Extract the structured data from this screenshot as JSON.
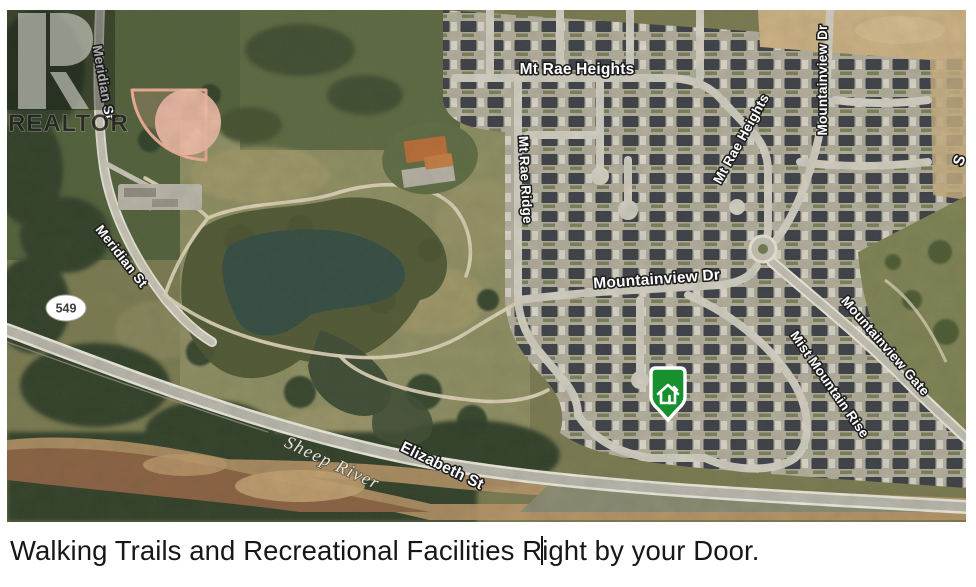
{
  "caption": {
    "before_cursor": "Walking Trails and Recreational Facilities R",
    "after_cursor": "ight by your Door."
  },
  "watermark": {
    "brand": "REALTOR",
    "registered_mark": "®"
  },
  "map": {
    "labels": {
      "mt_rae_heights_top": "Mt Rae Heights",
      "mt_rae_heights_diagonal": "Mt Rae Heights",
      "mountainview_dr_vertical": "Mountainview Dr",
      "mountainview_dr_horizontal": "Mountainview Dr",
      "mt_rae_ridge": "Mt Rae Ridge",
      "mountainview_gate": "Mountainview Gate",
      "mist_mountain_rise": "Mist Mountain Rise",
      "meridian_st_upper": "Meridian St",
      "meridian_st_lower": "Meridian St",
      "elizabeth_st": "Elizabeth St",
      "sheep_river": "Sheep River",
      "highway_shield": "549",
      "edge_partial_label": "S"
    },
    "marker": {
      "meaning": "property location"
    },
    "colors": {
      "marker_green": "#17902e",
      "parcel_pink": "#f0ac96",
      "pond_teal": "#314a41",
      "river_brown": "#8a5f40",
      "label_white": "#ffffff"
    }
  }
}
